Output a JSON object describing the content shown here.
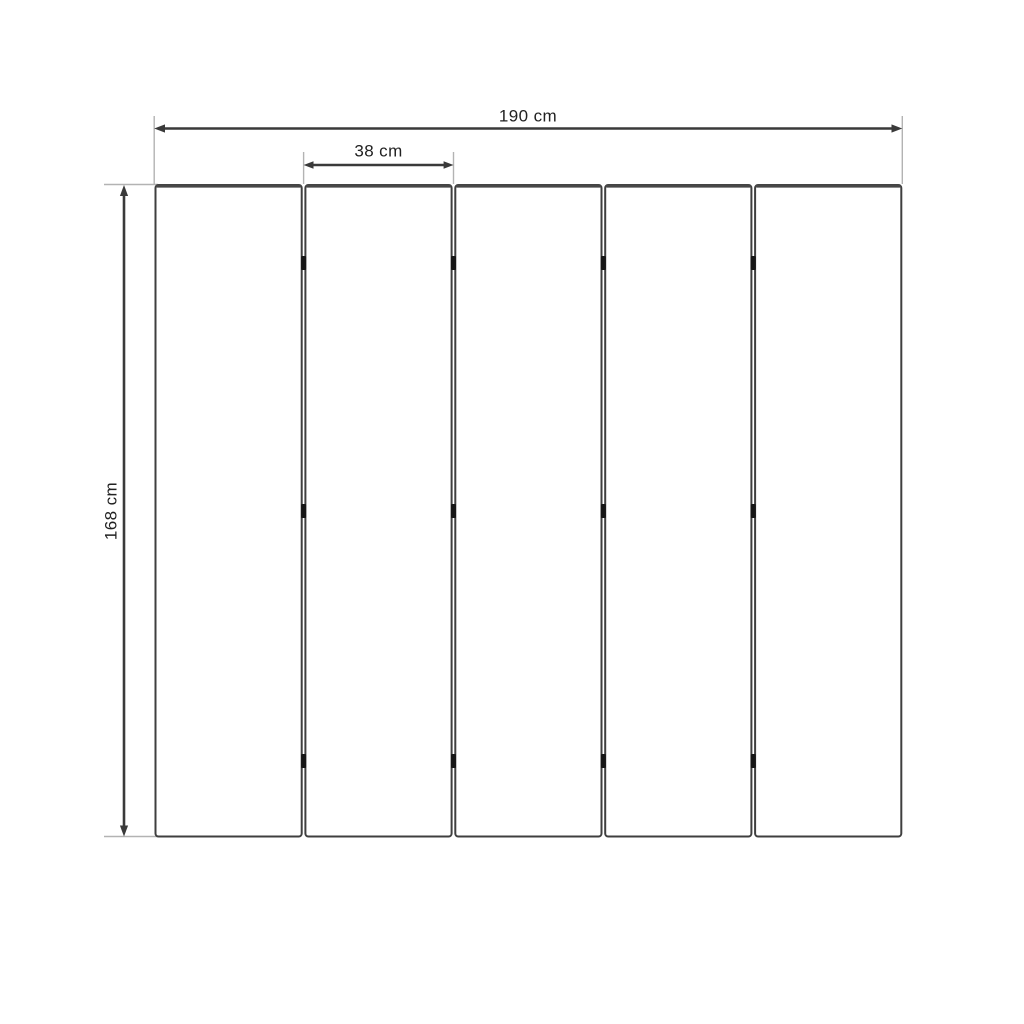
{
  "drawing": {
    "subject": "five-panel dimensioned technical drawing",
    "panel_count": 5,
    "hinge_rows_per_gap": 3,
    "labels": {
      "total_width": "190 cm",
      "panel_width": "38 cm",
      "height": "168 cm"
    },
    "colors": {
      "background": "#ffffff",
      "dimension_line": "#3a3a3a",
      "extension_line": "#b3b3b3",
      "panel_border": "#3f3f3f",
      "panel_top_edge": "#474747",
      "hinge": "#161616",
      "label_text": "#222222"
    }
  }
}
